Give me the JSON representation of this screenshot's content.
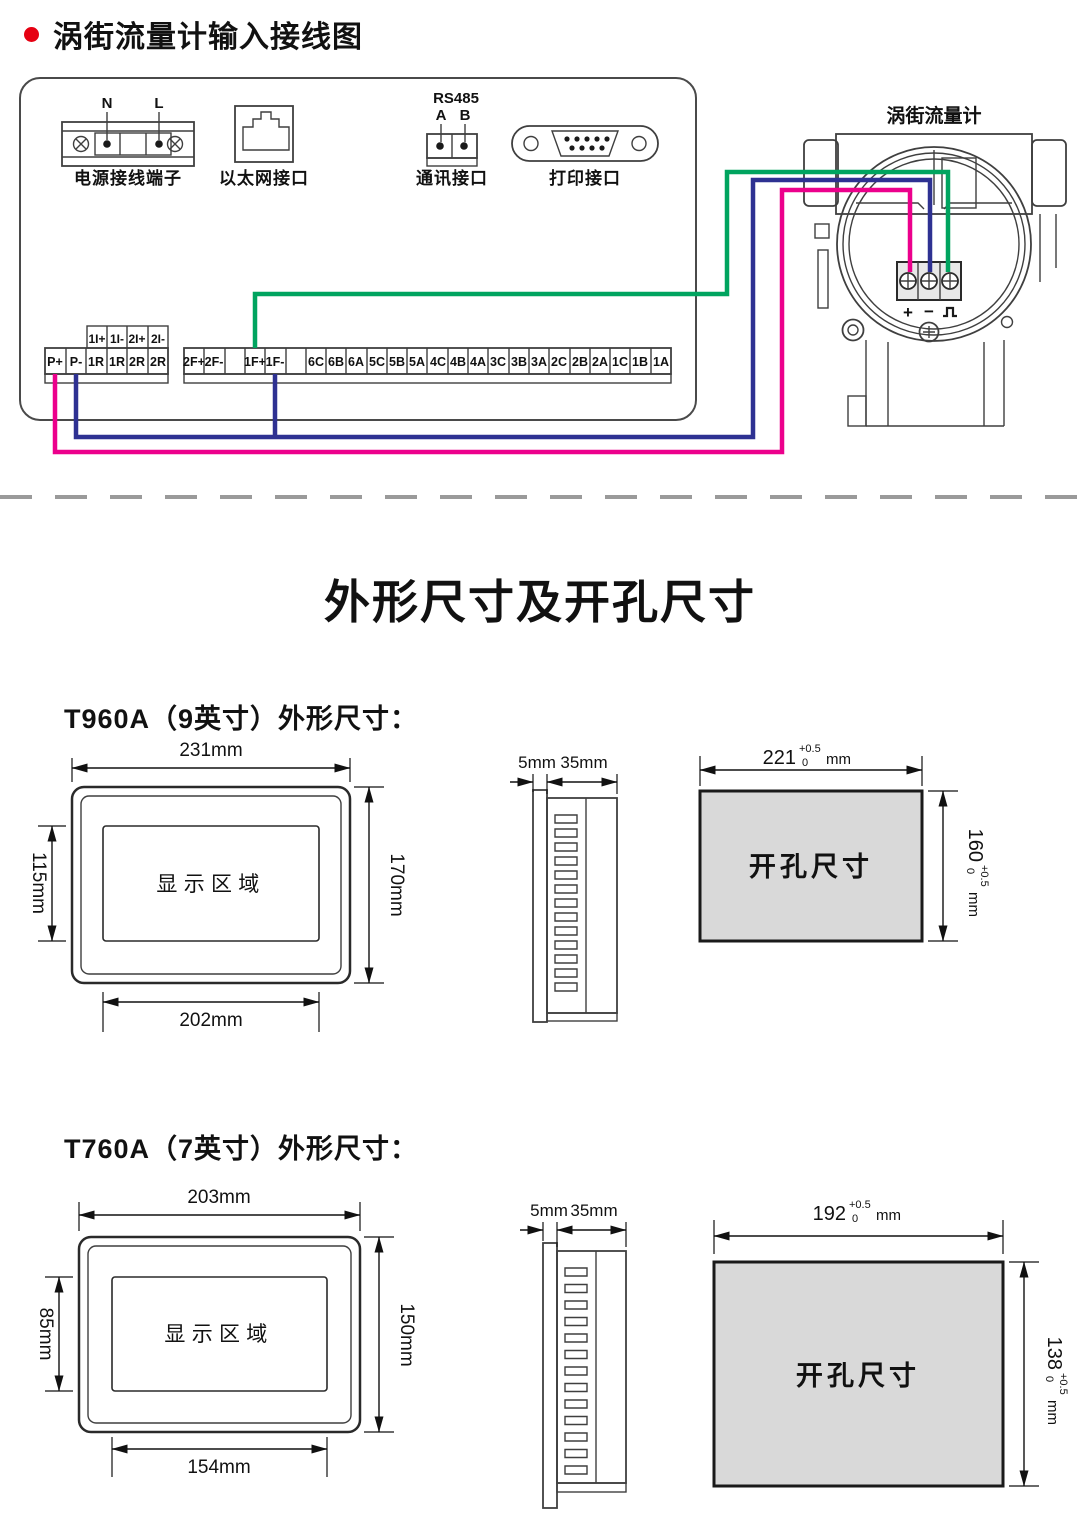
{
  "colors": {
    "red_bullet": "#e60012",
    "wire_green": "#00a45f",
    "wire_blue": "#2e3192",
    "wire_pink": "#ec008c",
    "cutout_fill": "#d9d9d9",
    "divider_gray": "#9a9a9a"
  },
  "wiring": {
    "title": "涡街流量计输入接线图",
    "power": {
      "label": "电源接线端子",
      "pin_n": "N",
      "pin_l": "L"
    },
    "ethernet": {
      "label": "以太网接口"
    },
    "comm": {
      "label": "通讯接口",
      "bus": "RS485",
      "pin_a": "A",
      "pin_b": "B"
    },
    "printer": {
      "label": "打印接口"
    },
    "flowmeter": {
      "label": "涡街流量计",
      "plus": "+",
      "minus": "−"
    },
    "strip_small": [
      "1I+",
      "1I-",
      "2I+",
      "2I-"
    ],
    "strip_left": [
      "P+",
      "P-",
      "1R",
      "1R",
      "2R",
      "2R"
    ],
    "strip_right": [
      "2F+",
      "2F-",
      "",
      "1F+",
      "1F-",
      "",
      "6C",
      "6B",
      "6A",
      "5C",
      "5B",
      "5A",
      "4C",
      "4B",
      "4A",
      "3C",
      "3B",
      "3A",
      "2C",
      "2B",
      "2A",
      "1C",
      "1B",
      "1A"
    ]
  },
  "section_title": "外形尺寸及开孔尺寸",
  "models": [
    {
      "heading": "T960A（9英寸）外形尺寸：",
      "front": {
        "area_label": "显示区域",
        "top": "231mm",
        "left": "115mm",
        "right": "170mm",
        "bottom": "202mm"
      },
      "side": {
        "bezel": "5mm",
        "depth": "35mm"
      },
      "cutout": {
        "label": "开孔尺寸",
        "w": "221",
        "w_tol_plus": "+0.5",
        "w_tol_minus": "0",
        "w_unit": "mm",
        "h": "160",
        "h_tol_plus": "+0.5",
        "h_tol_minus": "0",
        "h_unit": "mm"
      }
    },
    {
      "heading": "T760A（7英寸）外形尺寸：",
      "front": {
        "area_label": "显示区域",
        "top": "203mm",
        "left": "85mm",
        "right": "150mm",
        "bottom": "154mm"
      },
      "side": {
        "bezel": "5mm",
        "depth": "35mm"
      },
      "cutout": {
        "label": "开孔尺寸",
        "w": "192",
        "w_tol_plus": "+0.5",
        "w_tol_minus": "0",
        "w_unit": "mm",
        "h": "138",
        "h_tol_plus": "+0.5",
        "h_tol_minus": "0",
        "h_unit": "mm"
      }
    }
  ]
}
